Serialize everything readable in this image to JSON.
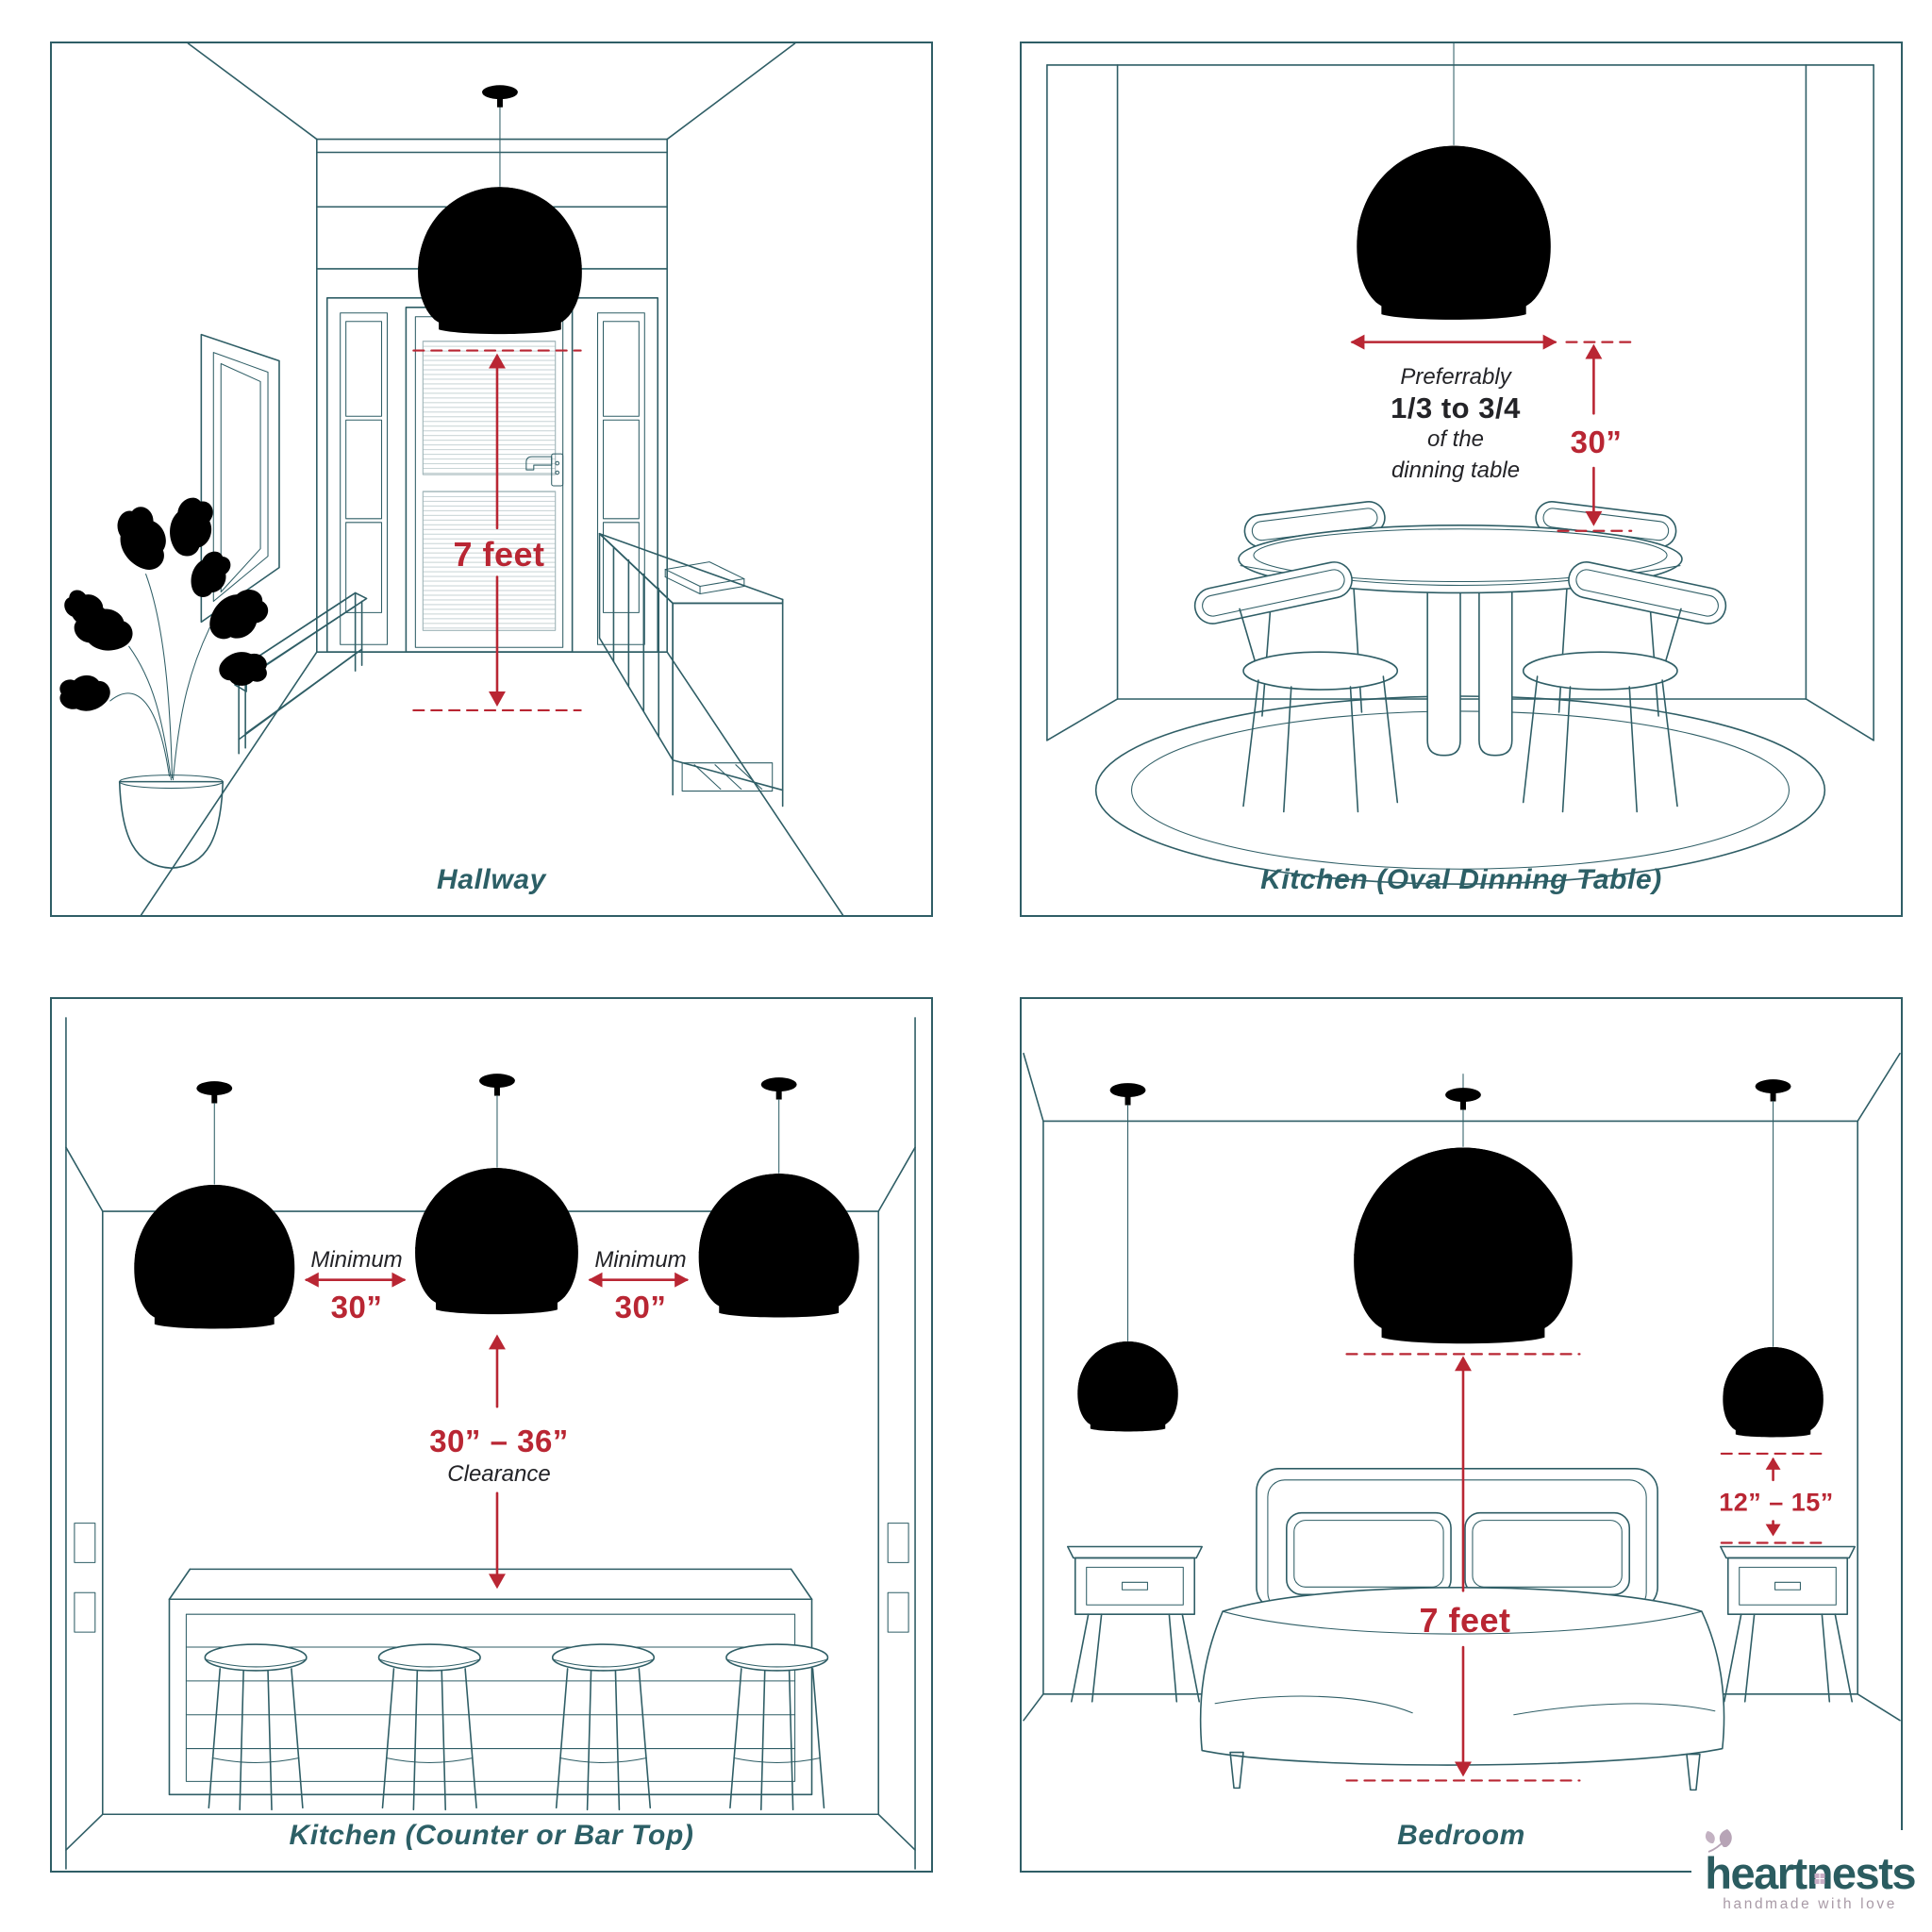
{
  "colors": {
    "line_teal": "#2f5e66",
    "accent_red": "#b92633",
    "text_dark": "#232327",
    "caption_teal": "#2c5f66",
    "logo_teal": "#2b5c60",
    "logo_mauve": "#b7a4b6",
    "tagline_gray": "#a99ba7"
  },
  "panels": {
    "hallway": {
      "caption": "Hallway",
      "height_label": "7 feet"
    },
    "kitchen_oval": {
      "caption": "Kitchen (Oval Dinning Table)",
      "pref_line1": "Preferrably",
      "pref_line2": "1/3 to 3/4",
      "pref_line3": "of the",
      "pref_line4": "dinning table",
      "drop_label": "30”"
    },
    "kitchen_counter": {
      "caption": "Kitchen (Counter or Bar Top)",
      "min_left_label": "Minimum",
      "min_left_value": "30”",
      "min_right_label": "Minimum",
      "min_right_value": "30”",
      "clearance_value": "30” – 36”",
      "clearance_label": "Clearance"
    },
    "bedroom": {
      "caption": "Bedroom",
      "height_label": "7 feet",
      "side_label": "12” – 15”"
    }
  },
  "logo": {
    "word_part1": "heart",
    "word_part2": "n",
    "word_part3": "ests",
    "tagline": "handmade with love"
  }
}
